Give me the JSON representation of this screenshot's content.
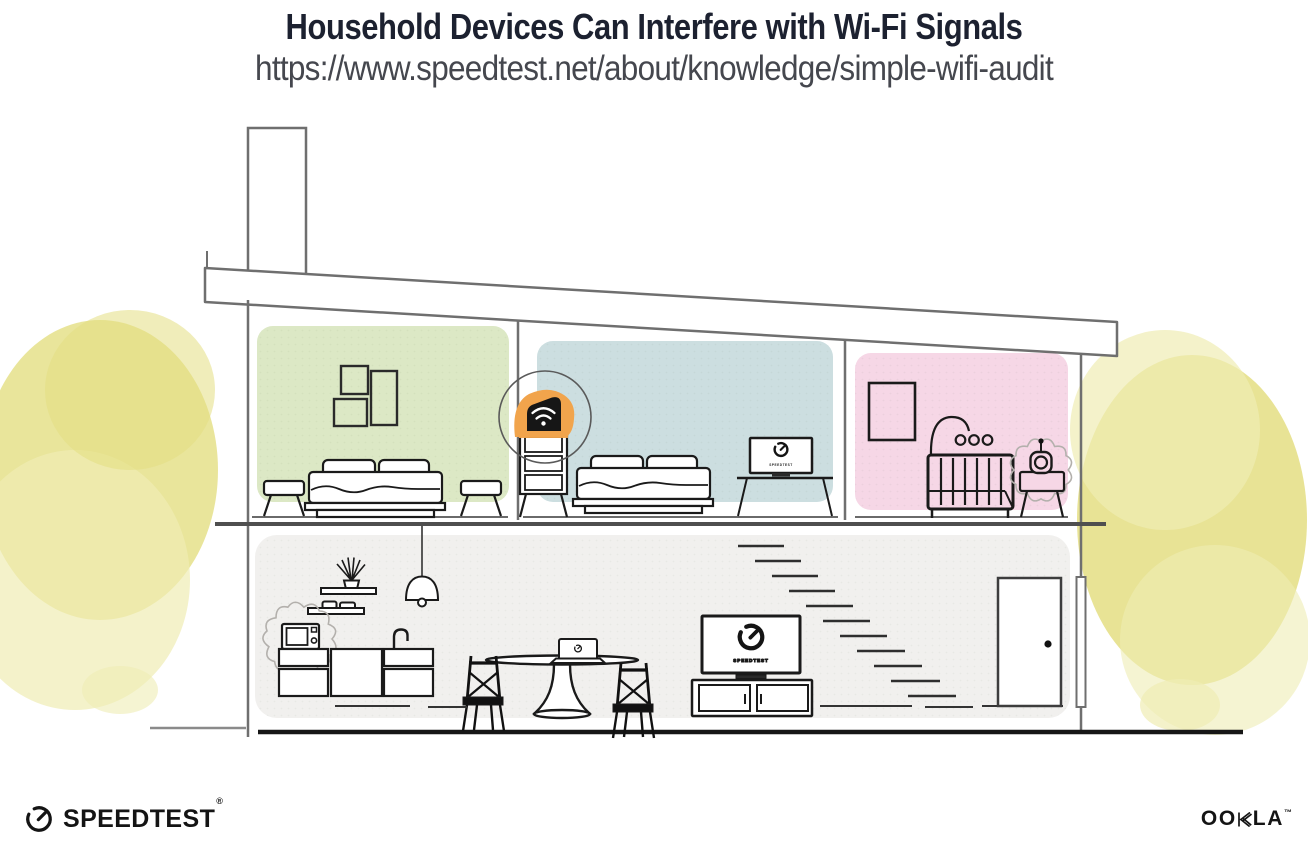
{
  "header": {
    "title": "Household Devices Can Interfere with Wi-Fi Signals",
    "url": "https://www.speedtest.net/about/knowledge/simple-wifi-audit"
  },
  "illustration": {
    "tv_label": "SPEEDTEST",
    "icons": {
      "wifi_router": "wifi-router-icon",
      "speedtest_gauge": "speedtest-gauge-icon",
      "microwave": "microwave-icon",
      "baby_monitor": "baby-monitor-icon",
      "interference_burst": "interference-burst"
    }
  },
  "branding": {
    "speedtest": "SPEEDTEST",
    "speedtest_mark": "®",
    "ookla_left": "OO",
    "ookla_right": "LA",
    "ookla_mark": "™"
  },
  "colors": {
    "title": "#1c2130",
    "url_text": "#45474e",
    "room_green": "#dce8c5",
    "room_blue": "#ccdee0",
    "room_pink": "#f6d7e6",
    "floor_gray": "#f1f0ee",
    "router_orange": "#f1a44c",
    "foliage": "#e4de82",
    "foliage_light": "#efecb4",
    "line_gray": "#6f6f6f",
    "ink": "#141414",
    "burst": "#b3b0ac"
  }
}
